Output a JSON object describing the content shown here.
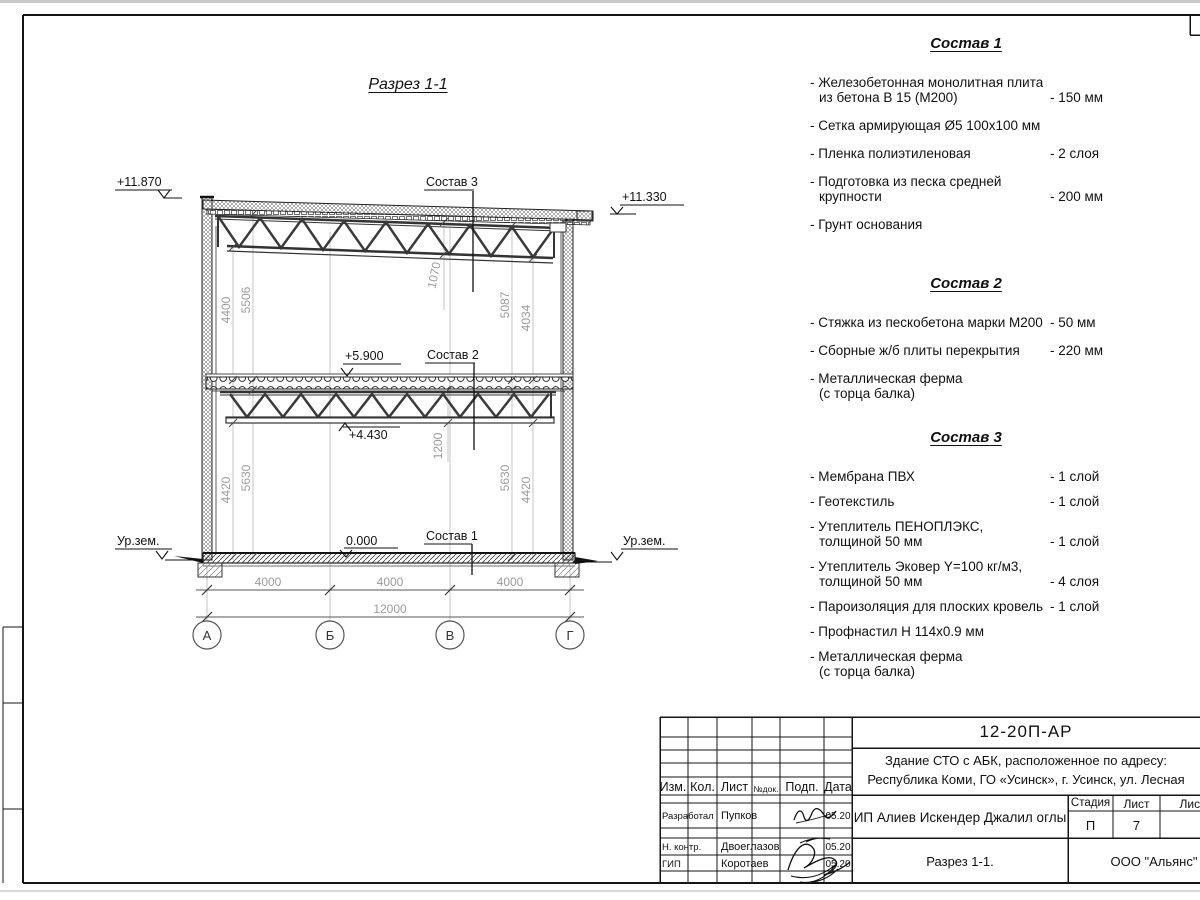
{
  "section": {
    "title": "Разрез 1-1",
    "elev_left_top": "+11.870",
    "elev_right_top": "+11.330",
    "elev_floor": "+5.900",
    "elev_truss": "+4.430",
    "elev_zero": "0.000",
    "ground_left": "Ур.зем.",
    "ground_right": "Ур.зем.",
    "label_s1": "Состав 1",
    "label_s2": "Состав 2",
    "label_s3": "Состав 3",
    "dim_4400": "4400",
    "dim_5506": "5506",
    "dim_5087": "5087",
    "dim_4034": "4034",
    "dim_4420l": "4420",
    "dim_5630l": "5630",
    "dim_5630r": "5630",
    "dim_4420r": "4420",
    "dim_1070": "1070",
    "dim_1200": "1200",
    "span1": "4000",
    "span2": "4000",
    "span3": "4000",
    "total": "12000",
    "axes": [
      "А",
      "Б",
      "В",
      "Г"
    ]
  },
  "compositions": [
    {
      "title": "Состав 1",
      "items": [
        {
          "line1": "- Железобетонная  монолитная плита",
          "line2": "из бетона В 15 (М200)",
          "value": "- 150 мм"
        },
        {
          "line1": "- Сетка армирующая Ø5 100х100 мм",
          "line2": "",
          "value": ""
        },
        {
          "line1": "- Пленка полиэтиленовая",
          "line2": "",
          "value": "-  2 слоя"
        },
        {
          "line1": "- Подготовка из песка средней",
          "line2": "крупности",
          "value": "- 200 мм"
        },
        {
          "line1": "- Грунт основания",
          "line2": "",
          "value": ""
        }
      ]
    },
    {
      "title": "Состав 2",
      "items": [
        {
          "line1": "- Стяжка из пескобетона марки М200",
          "line2": "",
          "value": "- 50 мм"
        },
        {
          "line1": "- Сборные ж/б плиты перекрытия",
          "line2": "",
          "value": "- 220 мм"
        },
        {
          "line1": "- Металлическая ферма",
          "line2": "(с торца балка)",
          "value": ""
        }
      ]
    },
    {
      "title": "Состав 3",
      "items": [
        {
          "line1": "- Мембрана ПВХ",
          "line2": "",
          "value": "- 1 слой"
        },
        {
          "line1": "- Геотекстиль",
          "line2": "",
          "value": "- 1 слой"
        },
        {
          "line1": "- Утеплитель ПЕНОПЛЭКС,",
          "line2": "толщиной 50 мм",
          "value": "- 1 слой"
        },
        {
          "line1": "- Утеплитель Эковер Y=100 кг/м3,",
          "line2": "толщиной 50 мм",
          "value": "- 4 слоя"
        },
        {
          "line1": "- Пароизоляция для плоских кровель",
          "line2": "",
          "value": "- 1 слой"
        },
        {
          "line1": "- Профнастил Н 114х0.9 мм",
          "line2": "",
          "value": ""
        },
        {
          "line1": "- Металлическая ферма",
          "line2": "(с торца балка)",
          "value": ""
        }
      ]
    }
  ],
  "title_block": {
    "doc_number": "12-20П-АР",
    "project_line1": "Здание СТО с АБК, расположенное по адресу:",
    "project_line2": "Республика Коми, ГО «Усинск», г. Усинск, ул. Лесная",
    "cols": [
      "Изм.",
      "Кол.",
      "Лист",
      "№док.",
      "Подп.",
      "Дата"
    ],
    "rows": [
      {
        "role": "Разработал",
        "name": "Пупков",
        "date": "05.20"
      },
      {
        "role": "Н. контр.",
        "name": "Двоеглазов",
        "date": "05.20"
      },
      {
        "role": "ГИП",
        "name": "Коротаев",
        "date": "05.20"
      }
    ],
    "client": "ИП Алиев Искендер Джалил оглы",
    "stage_label": "Стадия",
    "sheet_label": "Лист",
    "sheets_label": "Листов",
    "stage": "П",
    "sheet_no": "7",
    "view_name": "Разрез 1-1.",
    "company": "ООО \"Альянс\""
  }
}
